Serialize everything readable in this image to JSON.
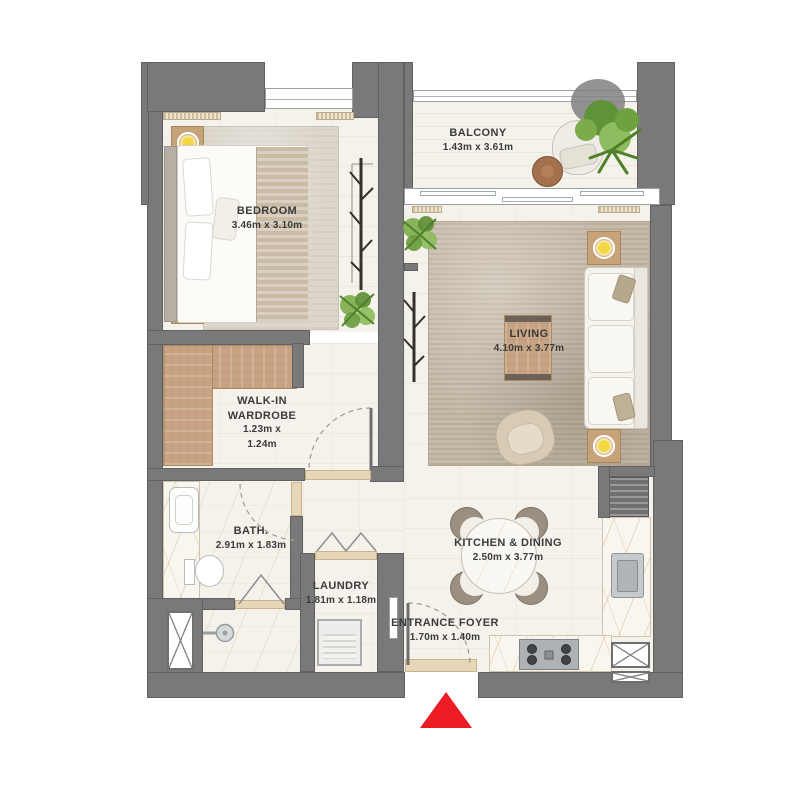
{
  "rooms": {
    "bedroom": {
      "name": "BEDROOM",
      "dims": "3.46m x 3.10m"
    },
    "balcony": {
      "name": "BALCONY",
      "dims": "1.43m x 3.61m"
    },
    "living": {
      "name": "LIVING",
      "dims": "4.10m x 3.77m"
    },
    "walkin": {
      "line1": "WALK-IN",
      "line2": "WARDROBE",
      "line3": "1.23m x",
      "line4": "1.24m"
    },
    "bath": {
      "name": "BATH.",
      "dims": "2.91m x 1.83m"
    },
    "laundry": {
      "name": "LAUNDRY",
      "dims": "1.81m x 1.18m"
    },
    "kitchen": {
      "name": "KITCHEN & DINING",
      "dims": "2.50m x 3.77m"
    },
    "foyer": {
      "name": "ENTRANCE FOYER",
      "dims": "1.70m x 1.40m"
    }
  },
  "markers": {
    "entrance": {
      "shape": "triangle-up",
      "color": "#ec1c24"
    }
  },
  "colors": {
    "wall": "#797979",
    "floor": "#f5f2ec",
    "wood": "#c7a383",
    "rug_bedroom": "#dcd6cb",
    "rug_living": "#c6baa9",
    "lamp_yellow": "#f2d741",
    "entrance_red": "#ec1c24",
    "label": "#3b3b3b"
  }
}
